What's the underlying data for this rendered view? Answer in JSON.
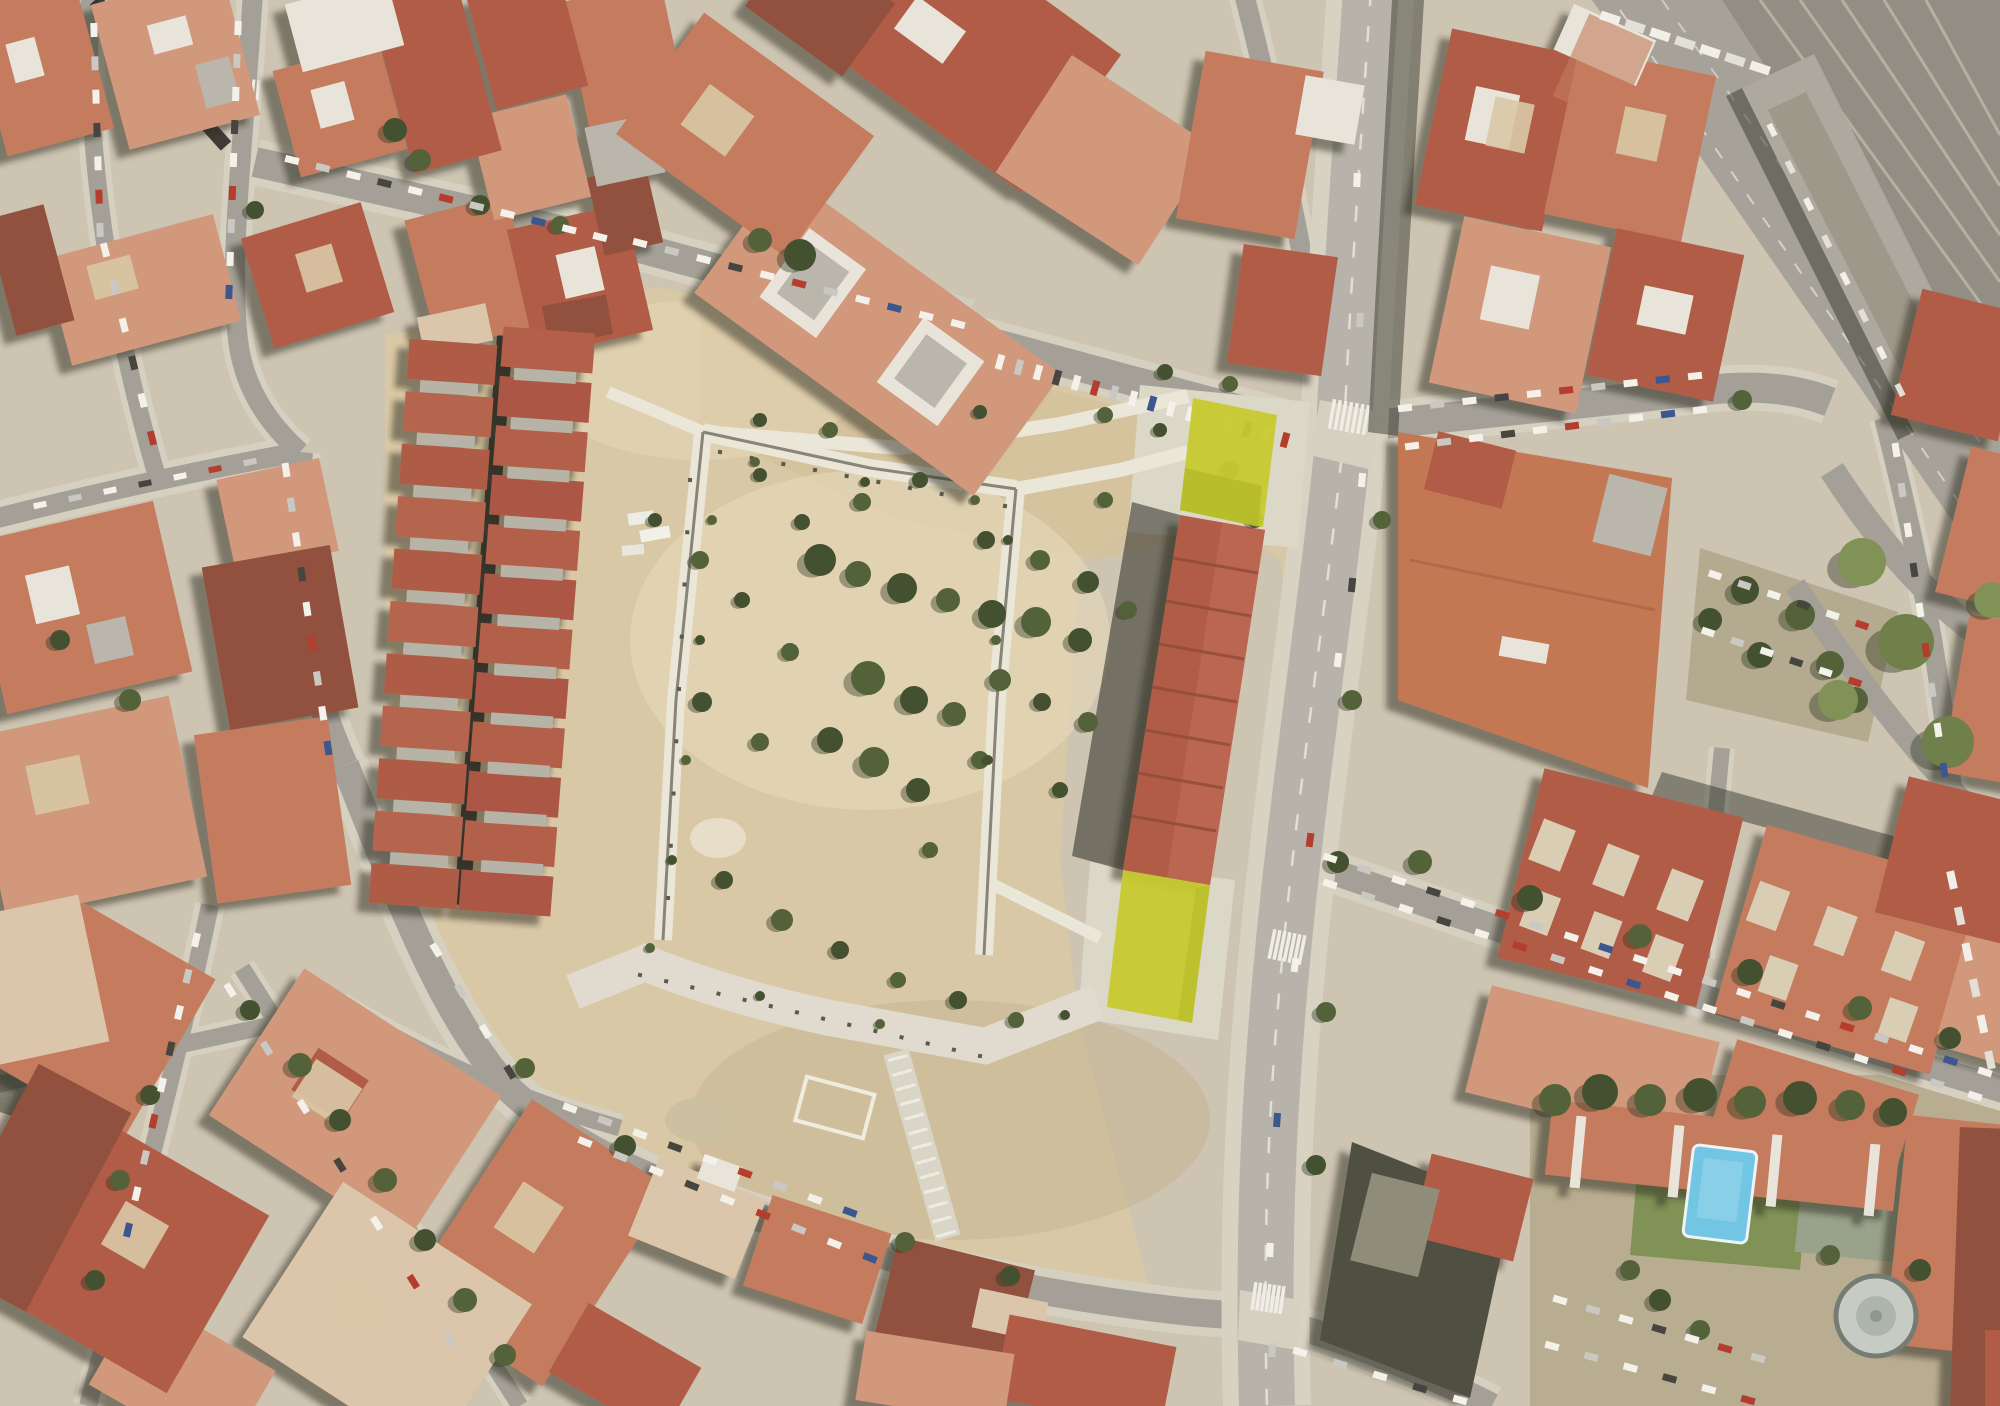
{
  "meta": {
    "kind": "satellite-aerial-photo",
    "description": "Aerial orthophoto of a dense Mediterranean urban district: terracotta-roofed blocks surround a large vacant sandy superblock with a concrete perimeter walkway; a main avenue runs along its east side; a rail corridor crosses the top-right; two parcels are highlighted in yellow-green.",
    "width": 2000,
    "height": 1406
  },
  "palette": {
    "ground": "#ccc3b3",
    "sand": "#d9c8a6",
    "sandLight": "#e6d8ba",
    "sandDark": "#c3b28e",
    "dirt": "#b7ab90",
    "path": "#eae7db",
    "esplanade": "#e0dcd0",
    "pathLine": "#6a675c",
    "asphalt": "#a19e96",
    "sidewalk": "#d5d0c2",
    "avenueAsphalt": "#b5b2ab",
    "avenueSidewalk": "#d7d2c4",
    "corridor": "#a4a098",
    "railbed": "#8f8b81",
    "railLine": "#b9b5ab",
    "platform": "#aba79d",
    "platformInner": "#999588",
    "shadow": "#20231c",
    "roofRed": "#ad5743",
    "roofTerra": "#c2775a",
    "roofSalmon": "#d09579",
    "roofDark": "#8e4a37",
    "roofPale": "#dbc6ac",
    "roofGray": "#b8b5ac",
    "roofWhite": "#e9e5dc",
    "courtSand": "#d9cdb4",
    "highlight": "#c5ca28",
    "highlightShade": "#b2b822",
    "pool": "#6cc4e6",
    "poolLight": "#8ed4ec",
    "lawn": "#7b8f52",
    "lawnDark": "#6a7c46",
    "tree": "#4c5c34",
    "treeDark": "#3b4a2b",
    "zebra": "#f0efe8",
    "laneDash": "#e8e6df"
  },
  "parcels": {
    "north": {
      "id": "parcel-north",
      "points": "1193,398 1277,415 1263,527 1180,510",
      "fill": "#c5ca28"
    },
    "north_shade": {
      "points": "1185,468 1262,486 1258,527 1180,510",
      "fill": "#b2b822"
    },
    "south": {
      "id": "parcel-south",
      "points": "1123,870 1210,885 1192,1023 1107,1007",
      "fill": "#c5ca28"
    },
    "south_shade": {
      "points": "1196,888 1210,885 1192,1023 1178,1019",
      "fill": "#b2b822"
    }
  },
  "rows": [
    {
      "layer": "units",
      "x1": 452,
      "y1": 362,
      "x2": 414,
      "y2": 886,
      "n": 11,
      "w": 40,
      "h": 88,
      "colors": [
        "#ac5742",
        "#b35f49"
      ]
    },
    {
      "layer": "units",
      "x1": 449,
      "y1": 388,
      "x2": 419,
      "y2": 860,
      "n": 10,
      "w": 12,
      "h": 58,
      "colors": [
        "#b5b1a6"
      ]
    },
    {
      "layer": "units",
      "x1": 548,
      "y1": 350,
      "x2": 506,
      "y2": 893,
      "n": 12,
      "w": 40,
      "h": 92,
      "colors": [
        "#b05a44",
        "#a95140"
      ]
    },
    {
      "layer": "units",
      "x1": 545,
      "y1": 376,
      "x2": 512,
      "y2": 868,
      "n": 11,
      "w": 12,
      "h": 62,
      "colors": [
        "#b5b1a6"
      ]
    },
    {
      "layer": "units",
      "x1": 1578,
      "y1": 1152,
      "x2": 1872,
      "y2": 1180,
      "n": 4,
      "w": 10,
      "h": 72,
      "colors": [
        "#e9e5dc"
      ]
    },
    {
      "layer": "units",
      "x1": 1552,
      "y1": 845,
      "x2": 1680,
      "y2": 895,
      "n": 3,
      "w": 34,
      "h": 44,
      "colors": [
        "#d9cdb4"
      ]
    },
    {
      "layer": "units",
      "x1": 1540,
      "y1": 912,
      "x2": 1663,
      "y2": 958,
      "n": 3,
      "w": 30,
      "h": 40,
      "colors": [
        "#d9cdb4"
      ]
    },
    {
      "layer": "units",
      "x1": 1768,
      "y1": 906,
      "x2": 1903,
      "y2": 956,
      "n": 3,
      "w": 32,
      "h": 42,
      "colors": [
        "#d9cdb4"
      ]
    },
    {
      "layer": "units",
      "x1": 1778,
      "y1": 978,
      "x2": 1898,
      "y2": 1020,
      "n": 2,
      "w": 30,
      "h": 38,
      "colors": [
        "#d9cdb4"
      ]
    },
    {
      "layer": "marks",
      "x1": 1332,
      "y1": 414,
      "x2": 1366,
      "y2": 420,
      "n": 7,
      "w": 3.5,
      "h": 30,
      "colors": [
        "#f0efe8"
      ]
    },
    {
      "layer": "marks",
      "x1": 1272,
      "y1": 944,
      "x2": 1302,
      "y2": 950,
      "n": 7,
      "w": 3.5,
      "h": 30,
      "colors": [
        "#f0efe8"
      ]
    },
    {
      "layer": "marks",
      "x1": 1254,
      "y1": 1296,
      "x2": 1282,
      "y2": 1300,
      "n": 7,
      "w": 3.5,
      "h": 28,
      "colors": [
        "#f0efe8"
      ]
    },
    {
      "layer": "marks",
      "x1": 1680,
      "y1": 948,
      "x2": 1706,
      "y2": 958,
      "n": 6,
      "w": 3.5,
      "h": 26,
      "colors": [
        "#f0efe8"
      ]
    },
    {
      "layer": "marks",
      "x1": 238,
      "y1": 88,
      "x2": 258,
      "y2": 90,
      "n": 5,
      "w": 3,
      "h": 20,
      "colors": [
        "#f0efe8"
      ]
    },
    {
      "layer": "marks",
      "x1": 288,
      "y1": 478,
      "x2": 312,
      "y2": 474,
      "n": 5,
      "w": 3,
      "h": 20,
      "colors": [
        "#f0efe8"
      ]
    },
    {
      "layer": "marks",
      "x1": 940,
      "y1": 322,
      "x2": 972,
      "y2": 330,
      "n": 6,
      "w": 3.5,
      "h": 24,
      "colors": [
        "#f0efe8"
      ]
    },
    {
      "layer": "dots",
      "x1": 640,
      "y1": 975,
      "x2": 980,
      "y2": 1056,
      "n": 14,
      "w": 4,
      "h": 4,
      "colors": [
        "#55544a"
      ]
    },
    {
      "layer": "dots",
      "x1": 720,
      "y1": 452,
      "x2": 1005,
      "y2": 506,
      "n": 10,
      "w": 4,
      "h": 4,
      "colors": [
        "#55544a"
      ]
    },
    {
      "layer": "dots",
      "x1": 690,
      "y1": 480,
      "x2": 668,
      "y2": 898,
      "n": 9,
      "w": 4,
      "h": 4,
      "colors": [
        "#55544a"
      ]
    },
    {
      "layer": "dots",
      "x1": 898,
      "y1": 1058,
      "x2": 946,
      "y2": 1234,
      "n": 13,
      "w": 3,
      "h": 20,
      "colors": [
        "#f0ede2"
      ]
    },
    {
      "layer": "cars",
      "x1": 94,
      "y1": 30,
      "x2": 100,
      "y2": 230,
      "n": 7,
      "w": 14,
      "h": 7
    },
    {
      "layer": "cars",
      "x1": 105,
      "y1": 250,
      "x2": 152,
      "y2": 438,
      "n": 6,
      "w": 14,
      "h": 7
    },
    {
      "layer": "cars",
      "x1": 238,
      "y1": 28,
      "x2": 229,
      "y2": 292,
      "n": 9,
      "w": 14,
      "h": 7
    },
    {
      "layer": "cars",
      "x1": 292,
      "y1": 160,
      "x2": 600,
      "y2": 237,
      "n": 11,
      "w": 14,
      "h": 7
    },
    {
      "layer": "cars",
      "x1": 640,
      "y1": 243,
      "x2": 958,
      "y2": 324,
      "n": 11,
      "w": 14,
      "h": 7
    },
    {
      "layer": "cars",
      "x1": 1000,
      "y1": 362,
      "x2": 1285,
      "y2": 440,
      "n": 16,
      "w": 7,
      "h": 15
    },
    {
      "layer": "cars",
      "x1": 286,
      "y1": 470,
      "x2": 328,
      "y2": 748,
      "n": 9,
      "w": 14,
      "h": 7
    },
    {
      "layer": "cars",
      "x1": 436,
      "y1": 950,
      "x2": 510,
      "y2": 1072,
      "n": 4,
      "w": 14,
      "h": 7
    },
    {
      "layer": "cars",
      "x1": 570,
      "y1": 1108,
      "x2": 850,
      "y2": 1212,
      "n": 9,
      "w": 14,
      "h": 7
    },
    {
      "layer": "cars",
      "x1": 585,
      "y1": 1142,
      "x2": 870,
      "y2": 1258,
      "n": 9,
      "w": 14,
      "h": 7
    },
    {
      "layer": "cars",
      "x1": 1300,
      "y1": 1352,
      "x2": 1460,
      "y2": 1400,
      "n": 5,
      "w": 14,
      "h": 7
    },
    {
      "layer": "cars",
      "x1": 1405,
      "y1": 408,
      "x2": 1695,
      "y2": 376,
      "n": 10,
      "w": 14,
      "h": 7
    },
    {
      "layer": "cars",
      "x1": 1412,
      "y1": 446,
      "x2": 1700,
      "y2": 410,
      "n": 10,
      "w": 14,
      "h": 7
    },
    {
      "layer": "cars",
      "x1": 1330,
      "y1": 858,
      "x2": 1985,
      "y2": 1072,
      "n": 20,
      "w": 14,
      "h": 7
    },
    {
      "layer": "cars",
      "x1": 1330,
      "y1": 884,
      "x2": 1975,
      "y2": 1096,
      "n": 18,
      "w": 14,
      "h": 7
    },
    {
      "layer": "cars",
      "x1": 1896,
      "y1": 450,
      "x2": 1944,
      "y2": 770,
      "n": 9,
      "w": 14,
      "h": 7
    },
    {
      "layer": "cars",
      "x1": 196,
      "y1": 940,
      "x2": 128,
      "y2": 1230,
      "n": 9,
      "w": 14,
      "h": 7
    },
    {
      "layer": "cars",
      "x1": 230,
      "y1": 990,
      "x2": 450,
      "y2": 1340,
      "n": 7,
      "w": 14,
      "h": 7
    },
    {
      "layer": "cars",
      "x1": 40,
      "y1": 505,
      "x2": 250,
      "y2": 462,
      "n": 7,
      "w": 13,
      "h": 6
    },
    {
      "layer": "cars",
      "x1": 1610,
      "y1": 18,
      "x2": 1760,
      "y2": 68,
      "n": 7,
      "w": 20,
      "h": 9,
      "colors": [
        "#f2f1ea",
        "#e2e1da"
      ]
    },
    {
      "layer": "cars",
      "x1": 1772,
      "y1": 130,
      "x2": 1900,
      "y2": 390,
      "n": 8,
      "w": 13,
      "h": 6,
      "colors": [
        "#f2f1ea",
        "#e2e1da"
      ]
    },
    {
      "layer": "cars",
      "x1": 1715,
      "y1": 575,
      "x2": 1862,
      "y2": 625,
      "n": 6,
      "w": 13,
      "h": 7
    },
    {
      "layer": "cars",
      "x1": 1708,
      "y1": 632,
      "x2": 1855,
      "y2": 682,
      "n": 6,
      "w": 13,
      "h": 7
    },
    {
      "layer": "cars",
      "x1": 1560,
      "y1": 1300,
      "x2": 1758,
      "y2": 1358,
      "n": 7,
      "w": 14,
      "h": 7
    },
    {
      "layer": "cars",
      "x1": 1552,
      "y1": 1346,
      "x2": 1748,
      "y2": 1400,
      "n": 6,
      "w": 14,
      "h": 7
    },
    {
      "layer": "cars",
      "x1": 1952,
      "y1": 880,
      "x2": 1990,
      "y2": 1060,
      "n": 6,
      "w": 18,
      "h": 8,
      "colors": [
        "#f2f1ea",
        "#e2e1da"
      ]
    }
  ],
  "car_palette": [
    "#f4f3ee",
    "#c8c8c3",
    "#f4f3ee",
    "#3e3e3a",
    "#f4f3ee",
    "#b23528",
    "#c8c8c3",
    "#f4f3ee",
    "#33518e",
    "#f4f3ee"
  ],
  "avenue_cars": [
    [
      1362,
      480,
      -85,
      "#f4f3ee"
    ],
    [
      1352,
      585,
      -84,
      "#3e3e3a"
    ],
    [
      1338,
      660,
      -83,
      "#f4f3ee"
    ],
    [
      1310,
      840,
      -82,
      "#b23528"
    ],
    [
      1295,
      965,
      -82,
      "#f4f3ee"
    ],
    [
      1277,
      1120,
      -86,
      "#33518e"
    ],
    [
      1270,
      1250,
      -88,
      "#f4f3ee"
    ],
    [
      1272,
      1350,
      -89,
      "#c8c8c3"
    ],
    [
      1357,
      180,
      -88,
      "#f4f3ee"
    ],
    [
      1360,
      320,
      -87,
      "#c8c8c3"
    ]
  ],
  "shrubs": {
    "lot": [
      [
        820,
        560,
        16
      ],
      [
        858,
        574,
        13
      ],
      [
        902,
        588,
        15
      ],
      [
        948,
        600,
        12
      ],
      [
        992,
        614,
        14
      ],
      [
        1036,
        622,
        15
      ],
      [
        1080,
        640,
        12
      ],
      [
        868,
        678,
        17
      ],
      [
        914,
        700,
        14
      ],
      [
        954,
        714,
        12
      ],
      [
        830,
        740,
        13
      ],
      [
        874,
        762,
        15
      ],
      [
        918,
        790,
        12
      ],
      [
        700,
        560,
        9
      ],
      [
        742,
        600,
        8
      ],
      [
        790,
        652,
        9
      ],
      [
        702,
        702,
        10
      ],
      [
        760,
        742,
        9
      ],
      [
        986,
        540,
        9
      ],
      [
        1040,
        560,
        10
      ],
      [
        1088,
        582,
        11
      ],
      [
        1128,
        610,
        9
      ],
      [
        920,
        480,
        8
      ],
      [
        862,
        502,
        9
      ],
      [
        802,
        522,
        8
      ],
      [
        1000,
        680,
        11
      ],
      [
        1042,
        702,
        9
      ],
      [
        1088,
        722,
        10
      ],
      [
        724,
        880,
        9
      ],
      [
        782,
        920,
        11
      ],
      [
        840,
        950,
        9
      ],
      [
        898,
        980,
        8
      ],
      [
        958,
        1000,
        9
      ],
      [
        1016,
        1020,
        8
      ],
      [
        760,
        475,
        7
      ],
      [
        1105,
        500,
        8
      ],
      [
        655,
        520,
        7
      ],
      [
        980,
        760,
        9
      ],
      [
        1060,
        790,
        8
      ],
      [
        930,
        850,
        8
      ],
      [
        760,
        420,
        7
      ],
      [
        830,
        430,
        8
      ],
      [
        980,
        412,
        7
      ],
      [
        1105,
        415,
        8
      ],
      [
        1160,
        430,
        7
      ],
      [
        1230,
        470,
        9
      ],
      [
        1255,
        520,
        8
      ]
    ],
    "paths": [
      [
        712,
        520,
        5
      ],
      [
        700,
        640,
        5
      ],
      [
        686,
        760,
        5
      ],
      [
        672,
        860,
        5
      ],
      [
        755,
        462,
        5
      ],
      [
        865,
        482,
        5
      ],
      [
        975,
        500,
        5
      ],
      [
        1008,
        540,
        5
      ],
      [
        996,
        640,
        5
      ],
      [
        988,
        760,
        5
      ],
      [
        650,
        948,
        5
      ],
      [
        760,
        996,
        5
      ],
      [
        880,
        1024,
        5
      ],
      [
        1065,
        1015,
        5
      ]
    ],
    "street_trees": [
      [
        300,
        1065,
        12
      ],
      [
        340,
        1120,
        11
      ],
      [
        385,
        1180,
        12
      ],
      [
        425,
        1240,
        11
      ],
      [
        465,
        1300,
        12
      ],
      [
        250,
        1010,
        10
      ],
      [
        505,
        1355,
        11
      ],
      [
        150,
        1095,
        10
      ],
      [
        120,
        1180,
        10
      ],
      [
        95,
        1280,
        10
      ],
      [
        1420,
        862,
        12
      ],
      [
        1530,
        898,
        13
      ],
      [
        1640,
        936,
        12
      ],
      [
        1750,
        972,
        13
      ],
      [
        1860,
        1008,
        12
      ],
      [
        1950,
        1038,
        11
      ],
      [
        525,
        1068,
        10
      ],
      [
        625,
        1146,
        11
      ],
      [
        905,
        1242,
        10
      ],
      [
        1010,
        1276,
        10
      ],
      [
        1352,
        700,
        10
      ],
      [
        1338,
        862,
        11
      ],
      [
        1326,
        1012,
        10
      ],
      [
        1316,
        1165,
        10
      ],
      [
        1382,
        520,
        9
      ],
      [
        480,
        205,
        10
      ],
      [
        560,
        225,
        9
      ],
      [
        255,
        210,
        9
      ],
      [
        1742,
        400,
        10
      ],
      [
        1165,
        372,
        8
      ],
      [
        1230,
        384,
        8
      ],
      [
        800,
        255,
        16
      ],
      [
        760,
        240,
        12
      ],
      [
        395,
        130,
        12
      ],
      [
        420,
        160,
        11
      ],
      [
        60,
        640,
        10
      ],
      [
        130,
        700,
        11
      ]
    ],
    "parking_trees": [
      [
        1745,
        590,
        14
      ],
      [
        1800,
        615,
        15
      ],
      [
        1760,
        655,
        13
      ],
      [
        1830,
        665,
        14
      ],
      [
        1710,
        620,
        12
      ],
      [
        1855,
        700,
        13
      ]
    ],
    "se_trees": [
      [
        1555,
        1100,
        16
      ],
      [
        1600,
        1092,
        18
      ],
      [
        1650,
        1100,
        16
      ],
      [
        1700,
        1095,
        17
      ],
      [
        1750,
        1102,
        16
      ],
      [
        1800,
        1098,
        17
      ],
      [
        1850,
        1105,
        15
      ],
      [
        1893,
        1112,
        14
      ],
      [
        1630,
        1270,
        10
      ],
      [
        1660,
        1300,
        11
      ],
      [
        1830,
        1255,
        10
      ],
      [
        1920,
        1270,
        11
      ],
      [
        1700,
        1330,
        10
      ]
    ],
    "corridor_green": [
      [
        1862,
        562,
        24
      ],
      [
        1906,
        642,
        28
      ],
      [
        1838,
        700,
        20
      ],
      [
        1948,
        742,
        26
      ],
      [
        1992,
        600,
        18
      ]
    ]
  }
}
